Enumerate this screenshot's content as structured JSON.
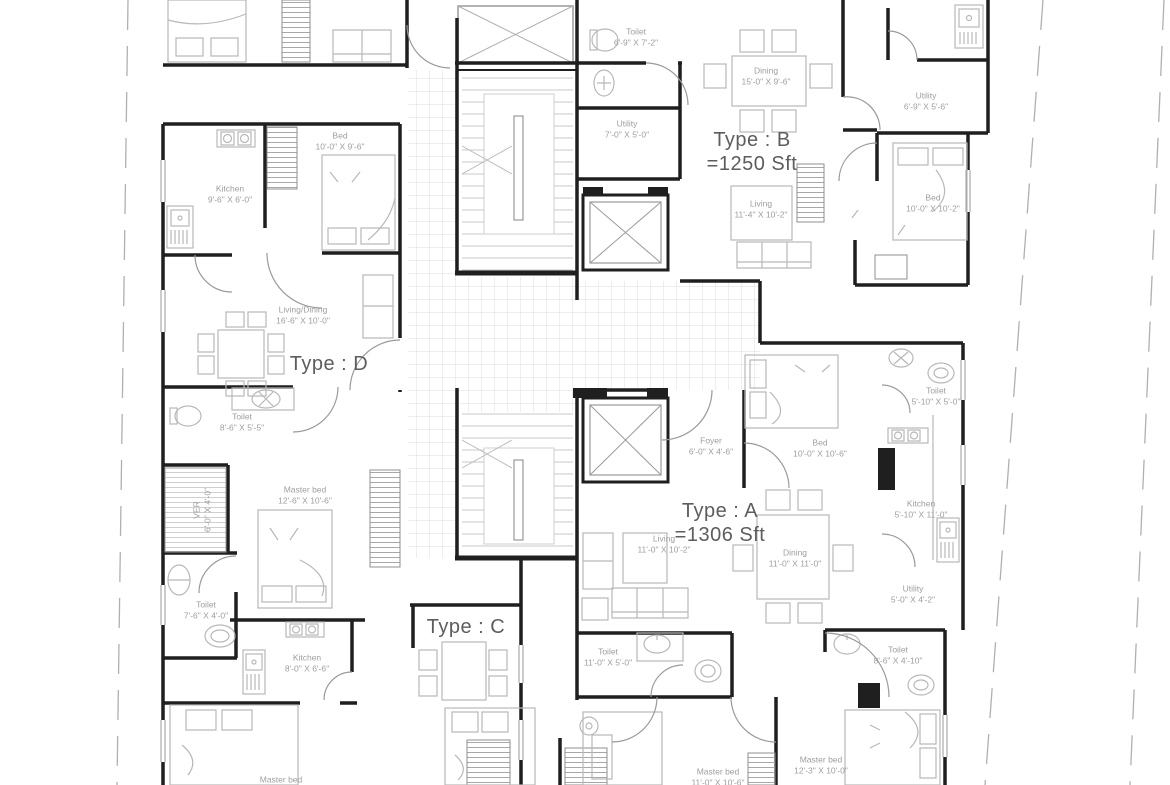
{
  "drawing": {
    "kind": "apartment-floor-plan"
  },
  "units": [
    {
      "label": "Type : B",
      "area": "=1250 Sft"
    },
    {
      "label": "Type : D",
      "area": ""
    },
    {
      "label": "Type : A",
      "area": "=1306 Sft"
    },
    {
      "label": "Type : C",
      "area": ""
    }
  ],
  "rooms": [
    {
      "name": "Toilet",
      "dims": "6'-9\" X 7'-2\""
    },
    {
      "name": "Dining",
      "dims": "15'-0\" X 9'-6\""
    },
    {
      "name": "Utility",
      "dims": "6'-9\" X 5'-6\""
    },
    {
      "name": "Utility",
      "dims": "7'-0\" X 5'-0\""
    },
    {
      "name": "Bed",
      "dims": "10'-0\" X 9'-6\""
    },
    {
      "name": "Kitchen",
      "dims": "9'-6\" X 6'-0\""
    },
    {
      "name": "Living",
      "dims": "11'-4\" X 10'-2\""
    },
    {
      "name": "Bed",
      "dims": "10'-0\" X 10'-2\""
    },
    {
      "name": "Living/Dining",
      "dims": "16'-6\" X 10'-0\""
    },
    {
      "name": "Toilet",
      "dims": "8'-6\" X 5'-5\""
    },
    {
      "name": "Toilet",
      "dims": "5'-10\" X 5'-0\""
    },
    {
      "name": "Foyer",
      "dims": "6'-0\" X 4'-6\""
    },
    {
      "name": "Bed",
      "dims": "10'-0\" X 10'-6\""
    },
    {
      "name": "Kitchen",
      "dims": "5'-10\" X 11'-0\""
    },
    {
      "name": "VER",
      "dims": "6'-0\" X 4'-0\""
    },
    {
      "name": "Master bed",
      "dims": "12'-6\" X 10'-6\""
    },
    {
      "name": "Living",
      "dims": "11'-0\" X 10'-2\""
    },
    {
      "name": "Dining",
      "dims": "11'-0\" X 11'-0\""
    },
    {
      "name": "Utility",
      "dims": "5'-0\" X 4'-2\""
    },
    {
      "name": "Toilet",
      "dims": "7'-6\" X 4'-0\""
    },
    {
      "name": "Kitchen",
      "dims": "8'-0\" X 6'-6\""
    },
    {
      "name": "Toilet",
      "dims": "11'-0\" X 5'-0\""
    },
    {
      "name": "Toilet",
      "dims": "8'-6\" X 4'-10\""
    },
    {
      "name": "Master bed",
      "dims": "11'-0\" X 10'-6\""
    },
    {
      "name": "Master bed",
      "dims": "12'-3\" X 10'-0\""
    },
    {
      "name": "Master bed",
      "dims": ""
    }
  ],
  "colors": {
    "wall": "#1f1f1f",
    "furniture": "#b8b8b8",
    "door": "#9a9a9a",
    "tile": "#dcdcdc",
    "room_label": "#9e9e9e",
    "type_label": "#5d5d5d",
    "site_boundary": "#b0b0b0"
  }
}
